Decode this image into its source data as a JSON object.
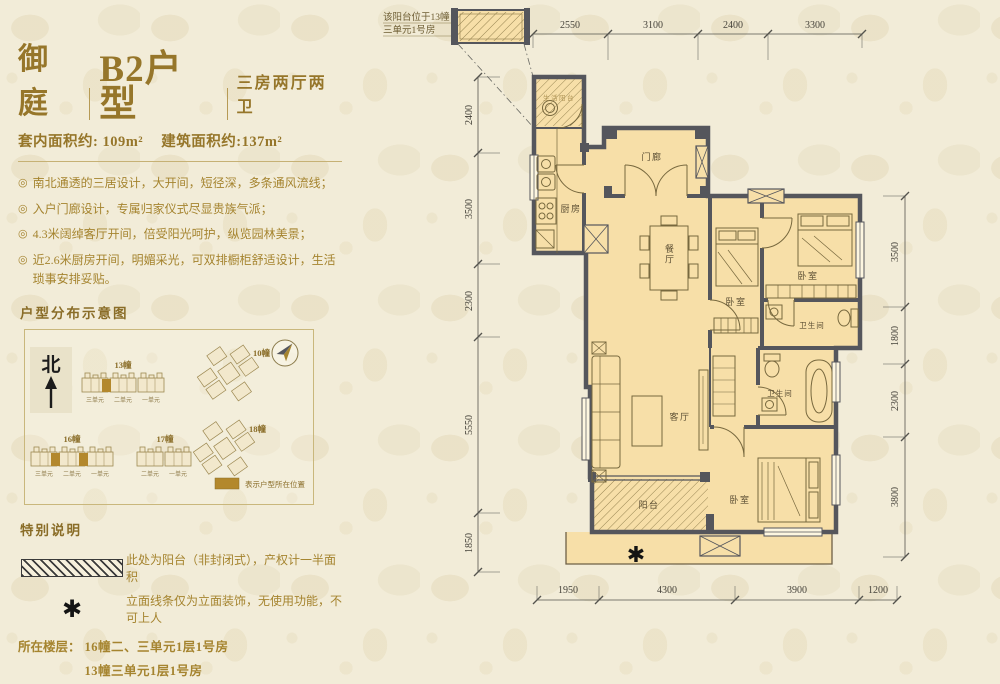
{
  "page": {
    "star_symbol": "✱"
  },
  "header": {
    "project": "御庭",
    "unit_name": "B2户型",
    "layout_type": "三房两厅两卫",
    "area_inner": "套内面积约: 109m²",
    "area_build": "建筑面积约:137m²"
  },
  "features": {
    "bullet_icon": "◎",
    "items": [
      "南北通透的三居设计，大开间，短径深，多条通风流线；",
      "入户门廊设计，专属归家仪式尽显贵族气派；",
      "4.3米阔绰客厅开间，倍受阳光呵护，纵览园林美景；",
      "近2.6米厨房开间，明媚采光，可双排橱柜舒适设计，生活琐事安排妥贴。"
    ]
  },
  "distribution": {
    "title": "户型分布示意图",
    "north_label": "北",
    "buildings": {
      "b13": {
        "name": "13幢",
        "units": [
          "三单元",
          "二单元",
          "一单元"
        ]
      },
      "b10": {
        "name": "10幢"
      },
      "b18": {
        "name": "18幢"
      },
      "b16": {
        "name": "16幢",
        "units": [
          "三单元",
          "二单元",
          "一单元"
        ]
      },
      "b17": {
        "name": "17幢",
        "units": [
          "二单元",
          "一单元"
        ]
      }
    },
    "legend_text": "表示户型所在位置"
  },
  "notes": {
    "title": "特别说明",
    "balcony_note": "此处为阳台（非封闭式），产权计一半面积",
    "star_note": "立面线条仅为立面装饰，无使用功能，不可上人",
    "floor_title": "所在楼层：",
    "floor_lines": [
      "16幢二、三单元1层1号房",
      "13幢三单元1层1号房"
    ]
  },
  "plan": {
    "annotation_line1": "该阳台位于13幢",
    "annotation_line2": "三单元1号房",
    "rooms": {
      "service_balcony": "生活阳台",
      "kitchen": "厨房",
      "porch": "门廊",
      "dining": "餐厅",
      "bedroom_center": "卧室",
      "bedroom_right": "卧室",
      "bath1": "卫生间",
      "living": "客厅",
      "bath2": "卫生间",
      "master": "卧室",
      "balcony": "阳台"
    },
    "dims": {
      "top": [
        "2550",
        "3100",
        "2400",
        "3300"
      ],
      "left": [
        "2400",
        "3500",
        "2300",
        "5550",
        "1850"
      ],
      "right": [
        "3500",
        "1800",
        "2300",
        "3800"
      ],
      "bottom": [
        "1950",
        "4300",
        "3900",
        "1200"
      ]
    }
  }
}
